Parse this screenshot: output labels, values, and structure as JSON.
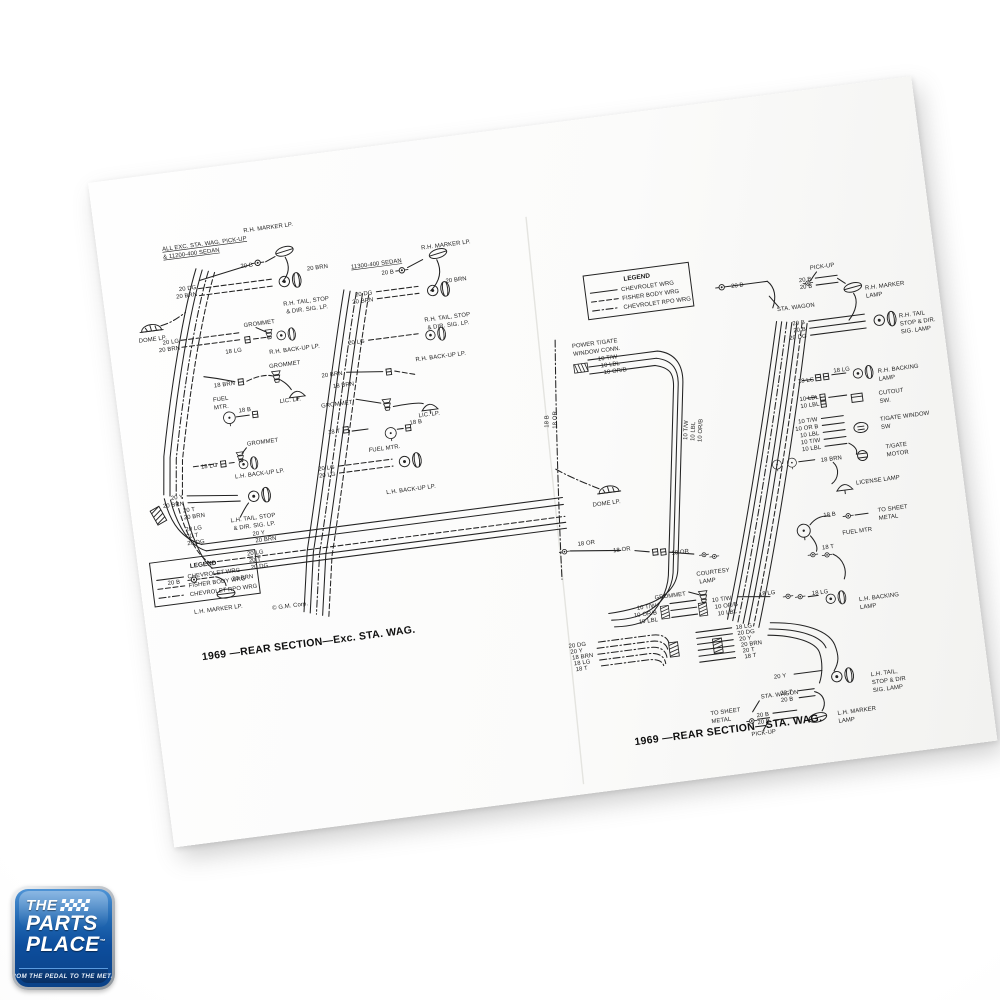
{
  "legend": {
    "title": "LEGEND",
    "entries": [
      {
        "style": "solid",
        "label": "CHEVROLET WRG"
      },
      {
        "style": "dashed",
        "label": "FISHER BODY WRG"
      },
      {
        "style": "dashdot",
        "label": "CHEVROLET RPO WRG"
      }
    ]
  },
  "diagrams": [
    {
      "id": "rear-section-exc-sta-wag",
      "caption": "1969 —REAR SECTION—Exc. STA. WAG.",
      "copyright": "© G.M. Corp.",
      "labels": [
        {
          "x": 55,
          "y": 22,
          "t": "ALL EXC. STA. WAG. PICK-UP",
          "u": 1
        },
        {
          "x": 55,
          "y": 30,
          "t": "& 11200-400 SEDAN",
          "u": 1
        },
        {
          "x": 138,
          "y": 14,
          "t": "R.H. MARKER LP."
        },
        {
          "x": 143,
          "y": 49,
          "t": "20 B",
          "a": "end"
        },
        {
          "x": 196,
          "y": 60,
          "t": "20 BRN"
        },
        {
          "x": 84,
          "y": 64,
          "t": "20 DG",
          "a": "end"
        },
        {
          "x": 84,
          "y": 71,
          "t": "20 BRN",
          "a": "end"
        },
        {
          "x": 168,
          "y": 92,
          "t": "R.H. TAIL, STOP"
        },
        {
          "x": 170,
          "y": 100,
          "t": "& DIR. SIG. LP."
        },
        {
          "x": 126,
          "y": 108,
          "t": "GROMMET"
        },
        {
          "x": 60,
          "y": 115,
          "t": "20 LG",
          "a": "end"
        },
        {
          "x": 60,
          "y": 122,
          "t": "20 BRN",
          "a": "end"
        },
        {
          "x": 121,
          "y": 132,
          "t": "18 LG",
          "a": "end"
        },
        {
          "x": 148,
          "y": 138,
          "t": "R.H. BACK-UP LP."
        },
        {
          "x": 20,
          "y": 110,
          "t": "DOME LP."
        },
        {
          "x": 146,
          "y": 152,
          "t": "GROMMET"
        },
        {
          "x": 110,
          "y": 164,
          "t": "18 BRN",
          "a": "end"
        },
        {
          "x": 152,
          "y": 188,
          "t": "LIC. LP."
        },
        {
          "x": 86,
          "y": 178,
          "t": "FUEL"
        },
        {
          "x": 86,
          "y": 186,
          "t": "MTR."
        },
        {
          "x": 110,
          "y": 192,
          "t": "18 B"
        },
        {
          "x": 114,
          "y": 226,
          "t": "GROMMET"
        },
        {
          "x": 82,
          "y": 243,
          "t": "18 LG",
          "a": "end"
        },
        {
          "x": 98,
          "y": 257,
          "t": "L.H. BACK-UP LP."
        },
        {
          "x": 240,
          "y": 64,
          "t": "11300-400 SEDAN",
          "u": 1
        },
        {
          "x": 312,
          "y": 54,
          "t": "R.H. MARKER LP."
        },
        {
          "x": 282,
          "y": 74,
          "t": "20 B",
          "a": "end"
        },
        {
          "x": 332,
          "y": 90,
          "t": "20 BRN"
        },
        {
          "x": 258,
          "y": 92,
          "t": "20 DG",
          "a": "end"
        },
        {
          "x": 258,
          "y": 99,
          "t": "20 BRN",
          "a": "end"
        },
        {
          "x": 306,
          "y": 126,
          "t": "R.H. TAIL, STOP"
        },
        {
          "x": 308,
          "y": 134,
          "t": "& DIR. SIG. LP."
        },
        {
          "x": 244,
          "y": 139,
          "t": "20 LG",
          "a": "end"
        },
        {
          "x": 292,
          "y": 164,
          "t": "R.H. BACK-UP LP."
        },
        {
          "x": 218,
          "y": 168,
          "t": "20 BRN",
          "a": "end"
        },
        {
          "x": 228,
          "y": 180,
          "t": "18 BRN",
          "a": "end"
        },
        {
          "x": 224,
          "y": 198,
          "t": "GROMMET",
          "a": "end"
        },
        {
          "x": 288,
          "y": 220,
          "t": "LIC. LP."
        },
        {
          "x": 208,
          "y": 225,
          "t": "18 T",
          "a": "end"
        },
        {
          "x": 278,
          "y": 226,
          "t": "18 B"
        },
        {
          "x": 234,
          "y": 248,
          "t": "FUEL MTR."
        },
        {
          "x": 198,
          "y": 260,
          "t": "20 LG",
          "a": "end"
        },
        {
          "x": 198,
          "y": 267,
          "t": "20 LG",
          "a": "end"
        },
        {
          "x": 246,
          "y": 292,
          "t": "L.H. BACK-UP LP."
        },
        {
          "x": 44,
          "y": 270,
          "t": "20 Y",
          "a": "end"
        },
        {
          "x": 44,
          "y": 277,
          "t": "20 BRN",
          "a": "end"
        },
        {
          "x": 88,
          "y": 300,
          "t": "L.H. TAIL, STOP"
        },
        {
          "x": 90,
          "y": 308,
          "t": "& DIR. SIG. LP."
        },
        {
          "x": 108,
          "y": 316,
          "t": "20 Y"
        },
        {
          "x": 110,
          "y": 323,
          "t": "20 BRN"
        },
        {
          "x": 100,
          "y": 335,
          "t": "20 LG"
        },
        {
          "x": 101,
          "y": 342,
          "t": "20 T"
        },
        {
          "x": 102,
          "y": 349,
          "t": "20 DG"
        },
        {
          "x": 30,
          "y": 354,
          "t": "20 B",
          "a": "end"
        },
        {
          "x": 82,
          "y": 358,
          "t": "20 BRN"
        },
        {
          "x": 40,
          "y": 386,
          "t": "L.H. MARKER LP."
        },
        {
          "x": 42,
          "y": 284,
          "t": "20 T"
        },
        {
          "x": 42,
          "y": 291,
          "t": "20 BRN"
        },
        {
          "x": 42,
          "y": 303,
          "t": "20 LG"
        },
        {
          "x": 42,
          "y": 310,
          "t": "20 T"
        },
        {
          "x": 42,
          "y": 317,
          "t": "20 DG"
        }
      ]
    },
    {
      "id": "rear-section-sta-wag",
      "caption": "1969 —REAR SECTION—STA. WAG.",
      "labels": [
        {
          "x": 222,
          "y": 57,
          "t": "20 B",
          "a": "end"
        },
        {
          "x": 290,
          "y": 49,
          "t": "PICK-UP"
        },
        {
          "x": 290,
          "y": 60,
          "t": "20 B",
          "a": "end"
        },
        {
          "x": 290,
          "y": 67,
          "t": "20 B",
          "a": "end"
        },
        {
          "x": 252,
          "y": 86,
          "t": "STA. WAGON"
        },
        {
          "x": 342,
          "y": 76,
          "t": "R.H. MARKER"
        },
        {
          "x": 342,
          "y": 84,
          "t": "LAMP"
        },
        {
          "x": 278,
          "y": 102,
          "t": "20 B",
          "a": "end"
        },
        {
          "x": 278,
          "y": 109,
          "t": "20 B",
          "a": "end"
        },
        {
          "x": 278,
          "y": 116,
          "t": "20 DG",
          "a": "end"
        },
        {
          "x": 372,
          "y": 108,
          "t": "R.H. TAIL"
        },
        {
          "x": 372,
          "y": 116,
          "t": "STOP & DIR."
        },
        {
          "x": 372,
          "y": 124,
          "t": "SIG. LAMP"
        },
        {
          "x": 280,
          "y": 160,
          "t": "18 LG",
          "a": "end"
        },
        {
          "x": 300,
          "y": 154,
          "t": "18 LG"
        },
        {
          "x": 344,
          "y": 160,
          "t": "R.H. BACKING"
        },
        {
          "x": 344,
          "y": 168,
          "t": "LAMP"
        },
        {
          "x": 282,
          "y": 178,
          "t": "10 LBL",
          "a": "end"
        },
        {
          "x": 282,
          "y": 185,
          "t": "10 LBL",
          "a": "end"
        },
        {
          "x": 342,
          "y": 182,
          "t": "CUTOUT"
        },
        {
          "x": 342,
          "y": 190,
          "t": "SW."
        },
        {
          "x": 278,
          "y": 200,
          "t": "10 T/W",
          "a": "end"
        },
        {
          "x": 278,
          "y": 207,
          "t": "10 OR B",
          "a": "end"
        },
        {
          "x": 278,
          "y": 214,
          "t": "10 LBL",
          "a": "end"
        },
        {
          "x": 278,
          "y": 221,
          "t": "10 T/W",
          "a": "end"
        },
        {
          "x": 278,
          "y": 228,
          "t": "10 LBL",
          "a": "end"
        },
        {
          "x": 340,
          "y": 208,
          "t": "T/GATE WINDOW"
        },
        {
          "x": 340,
          "y": 216,
          "t": "SW"
        },
        {
          "x": 342,
          "y": 236,
          "t": "T/GATE"
        },
        {
          "x": 342,
          "y": 244,
          "t": "MOTOR"
        },
        {
          "x": 276,
          "y": 241,
          "t": "18 BRN"
        },
        {
          "x": 308,
          "y": 268,
          "t": "LICENSE LAMP"
        },
        {
          "x": 44,
          "y": 96,
          "t": "POWER T/GATE"
        },
        {
          "x": 44,
          "y": 104,
          "t": "WINDOW CONN."
        },
        {
          "x": 68,
          "y": 112,
          "t": "10 T/W"
        },
        {
          "x": 70,
          "y": 119,
          "t": "10 LBL"
        },
        {
          "x": 72,
          "y": 126,
          "t": "10 OR/B"
        },
        {
          "x": 10,
          "y": 172,
          "t": "18 B",
          "r": -82
        },
        {
          "x": 18,
          "y": 174,
          "t": "18 OR",
          "r": -82
        },
        {
          "x": 146,
          "y": 202,
          "t": "10 T/W",
          "r": -80
        },
        {
          "x": 153,
          "y": 204,
          "t": "10 LBL",
          "r": -80
        },
        {
          "x": 160,
          "y": 206,
          "t": "10 OR/B",
          "r": -80
        },
        {
          "x": 44,
          "y": 256,
          "t": "DOME LP."
        },
        {
          "x": 24,
          "y": 293,
          "t": "18 OR"
        },
        {
          "x": 76,
          "y": 304,
          "t": "18 OR",
          "a": "end"
        },
        {
          "x": 116,
          "y": 314,
          "t": "18 OR"
        },
        {
          "x": 138,
          "y": 338,
          "t": "COURTESY"
        },
        {
          "x": 140,
          "y": 346,
          "t": "LAMP"
        },
        {
          "x": 125,
          "y": 356,
          "t": "GROMMET",
          "a": "end"
        },
        {
          "x": 214,
          "y": 366,
          "t": "18 LG",
          "a": "end"
        },
        {
          "x": 250,
          "y": 372,
          "t": "18 LG"
        },
        {
          "x": 296,
          "y": 384,
          "t": "L.H. BACKING"
        },
        {
          "x": 296,
          "y": 392,
          "t": "LAMP"
        },
        {
          "x": 284,
          "y": 296,
          "t": "18 B",
          "a": "end"
        },
        {
          "x": 326,
          "y": 298,
          "t": "TO SHEET"
        },
        {
          "x": 326,
          "y": 306,
          "t": "METAL"
        },
        {
          "x": 288,
          "y": 316,
          "t": "FUEL MTR"
        },
        {
          "x": 278,
          "y": 328,
          "t": "18 T",
          "a": "end"
        },
        {
          "x": 94,
          "y": 364,
          "t": "10 T/W",
          "a": "end"
        },
        {
          "x": 94,
          "y": 371,
          "t": "10 OR/B",
          "a": "end"
        },
        {
          "x": 94,
          "y": 378,
          "t": "10 LBL",
          "a": "end"
        },
        {
          "x": 150,
          "y": 366,
          "t": "10 T/W"
        },
        {
          "x": 152,
          "y": 373,
          "t": "10 OR/B"
        },
        {
          "x": 154,
          "y": 380,
          "t": "10 LBL"
        },
        {
          "x": 2,
          "y": 393,
          "t": "20 DG"
        },
        {
          "x": 3,
          "y": 399,
          "t": "20 Y"
        },
        {
          "x": 4,
          "y": 405,
          "t": "18 BRN"
        },
        {
          "x": 5,
          "y": 411,
          "t": "18 LG"
        },
        {
          "x": 6,
          "y": 417,
          "t": "18 T"
        },
        {
          "x": 170,
          "y": 396,
          "t": "18 LG"
        },
        {
          "x": 171,
          "y": 402,
          "t": "20 DG"
        },
        {
          "x": 172,
          "y": 408,
          "t": "20 Y"
        },
        {
          "x": 173,
          "y": 414,
          "t": "20 BRN"
        },
        {
          "x": 174,
          "y": 420,
          "t": "20 T"
        },
        {
          "x": 175,
          "y": 426,
          "t": "18 T"
        },
        {
          "x": 214,
          "y": 450,
          "t": "20 Y",
          "a": "end"
        },
        {
          "x": 218,
          "y": 467,
          "t": "20 T",
          "a": "end"
        },
        {
          "x": 218,
          "y": 474,
          "t": "20 B",
          "a": "end"
        },
        {
          "x": 298,
          "y": 460,
          "t": "L.H. TAIL,"
        },
        {
          "x": 298,
          "y": 468,
          "t": "STOP & DIR"
        },
        {
          "x": 298,
          "y": 476,
          "t": "SIG. LAMP"
        },
        {
          "x": 186,
          "y": 468,
          "t": "STA. WAGON"
        },
        {
          "x": 134,
          "y": 478,
          "t": "TO SHEET"
        },
        {
          "x": 134,
          "y": 486,
          "t": "METAL"
        },
        {
          "x": 192,
          "y": 486,
          "t": "20 B",
          "a": "end"
        },
        {
          "x": 192,
          "y": 493,
          "t": "20 B",
          "a": "end"
        },
        {
          "x": 260,
          "y": 494,
          "t": "L.H. MARKER"
        },
        {
          "x": 260,
          "y": 502,
          "t": "LAMP"
        },
        {
          "x": 172,
          "y": 504,
          "t": "PICK-UP"
        }
      ]
    }
  ],
  "logo": {
    "the": "THE",
    "parts": "PARTS",
    "place": "PLACE",
    "tm": "™",
    "tagline": "FROM THE PEDAL TO THE METAL",
    "colors": {
      "blue": "#0d4e9d",
      "silver": "#b7bcc2",
      "banner": "#092f63"
    }
  }
}
